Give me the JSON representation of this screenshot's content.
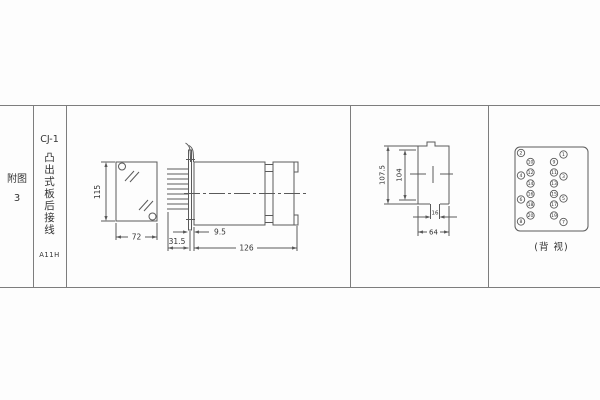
{
  "figure_column": {
    "label": "附图3"
  },
  "title_column": {
    "model": "CJ-1",
    "mounting_type": "凸出式板后接线",
    "code": "A11H"
  },
  "dimensions": {
    "front_view": {
      "height": "115",
      "width": "72"
    },
    "side_view": {
      "pin_length": "31.5",
      "flange_offset": "9.5",
      "body_length": "126"
    },
    "cutout": {
      "outer_height": "107.5",
      "inner_height": "104",
      "slot_width": "16",
      "width": "64"
    }
  },
  "rear_view": {
    "caption": "(背 视)",
    "terminals": {
      "outer_left": [
        "2",
        "4",
        "6",
        "8"
      ],
      "inner_left": [
        "10",
        "12",
        "14",
        "16",
        "18",
        "20"
      ],
      "inner_right": [
        "9",
        "11",
        "13",
        "15",
        "17",
        "19"
      ],
      "outer_right": [
        "1",
        "3",
        "5",
        "7"
      ]
    }
  }
}
